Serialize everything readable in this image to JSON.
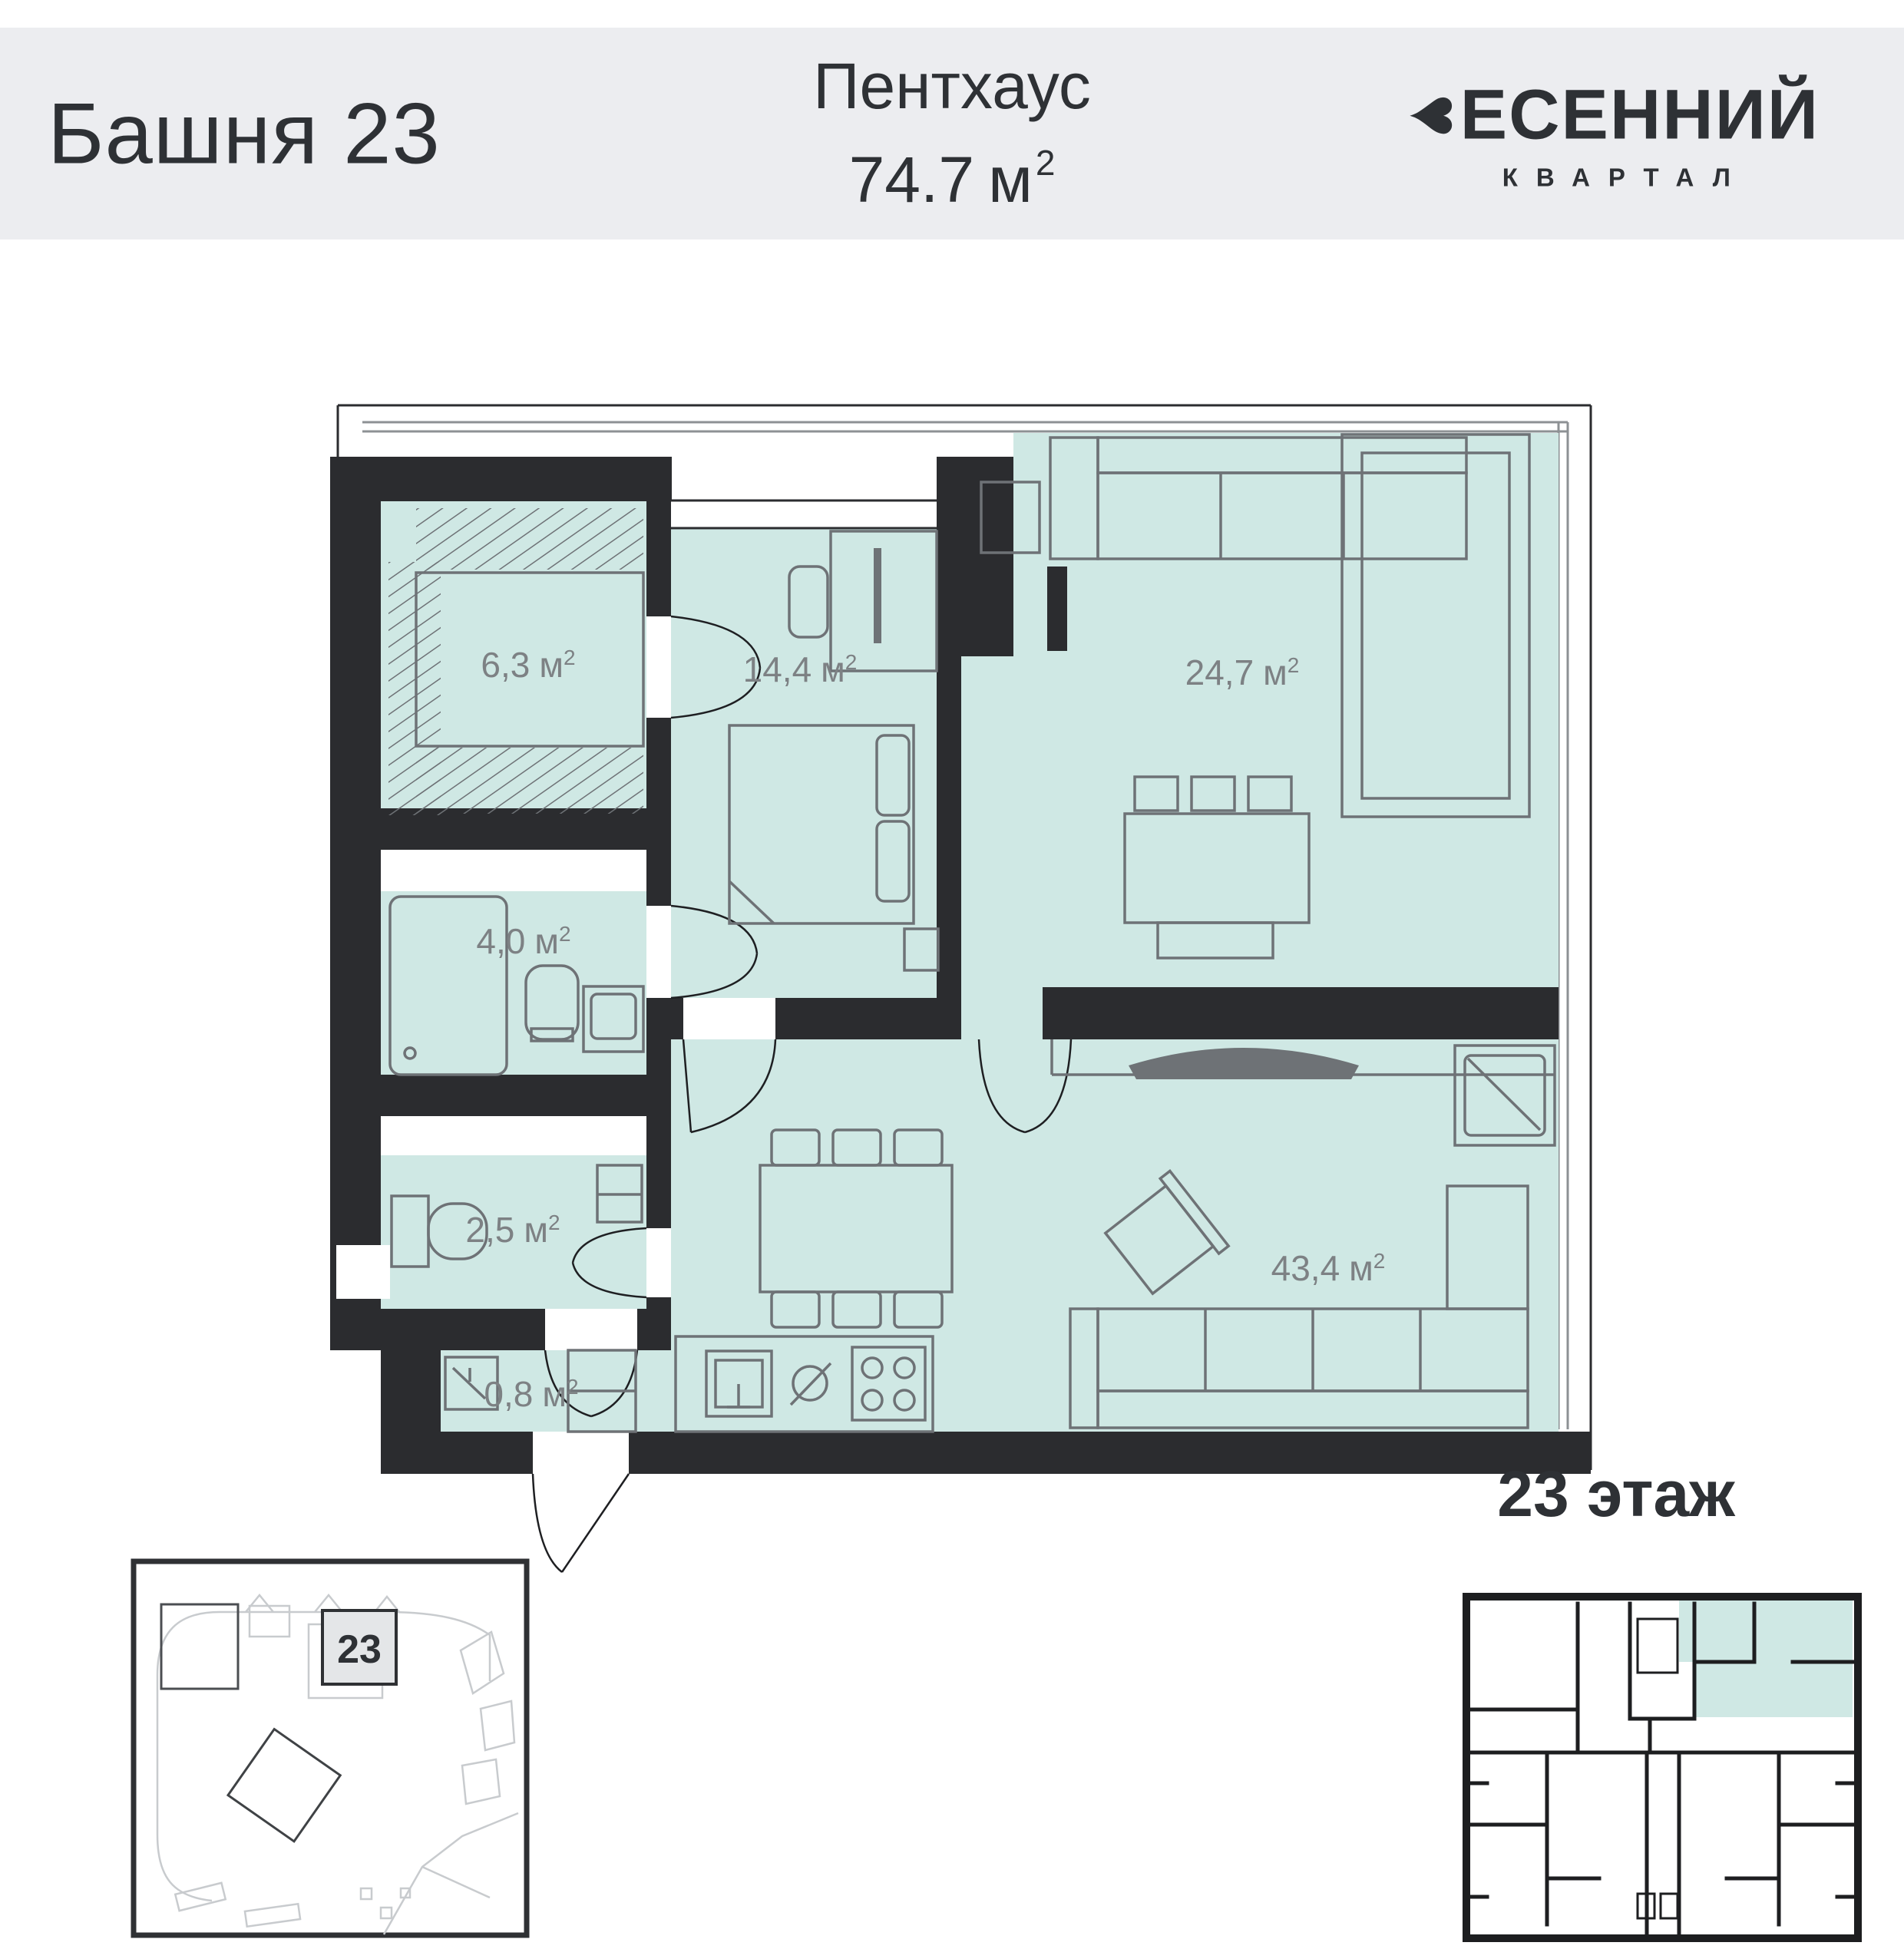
{
  "header": {
    "tower_title": "Башня 23",
    "type_label": "Пентхаус",
    "area_value": "74.7",
    "area_unit": "м",
    "area_sup": "2",
    "logo": {
      "icon": "heart-leaf-icon",
      "heart_glyph": "♥",
      "wordmark_rest": "ЕСЕННИЙ",
      "subtitle": "КВАРТАЛ"
    }
  },
  "plan": {
    "unit_m": "м",
    "unit_sup": "2",
    "rooms": [
      {
        "id": "wardrobe",
        "area": "6,3"
      },
      {
        "id": "bedroom",
        "area": "14,4"
      },
      {
        "id": "lounge",
        "area": "24,7"
      },
      {
        "id": "bathroom",
        "area": "4,0"
      },
      {
        "id": "wc",
        "area": "2,5"
      },
      {
        "id": "hall",
        "area": "0,8"
      },
      {
        "id": "living-kitchen",
        "area": "43,4"
      }
    ]
  },
  "site_plan": {
    "building_number": "23"
  },
  "floor_overview": {
    "title": "23 этаж"
  },
  "colors": {
    "header_bg": "#ecedf0",
    "room_fill": "#cfe8e4",
    "wall": "#2b2c2f",
    "furniture": "#6e7276",
    "label_text": "#7d8184",
    "dark_text": "#2e3135",
    "map_light": "#c8cbce"
  }
}
